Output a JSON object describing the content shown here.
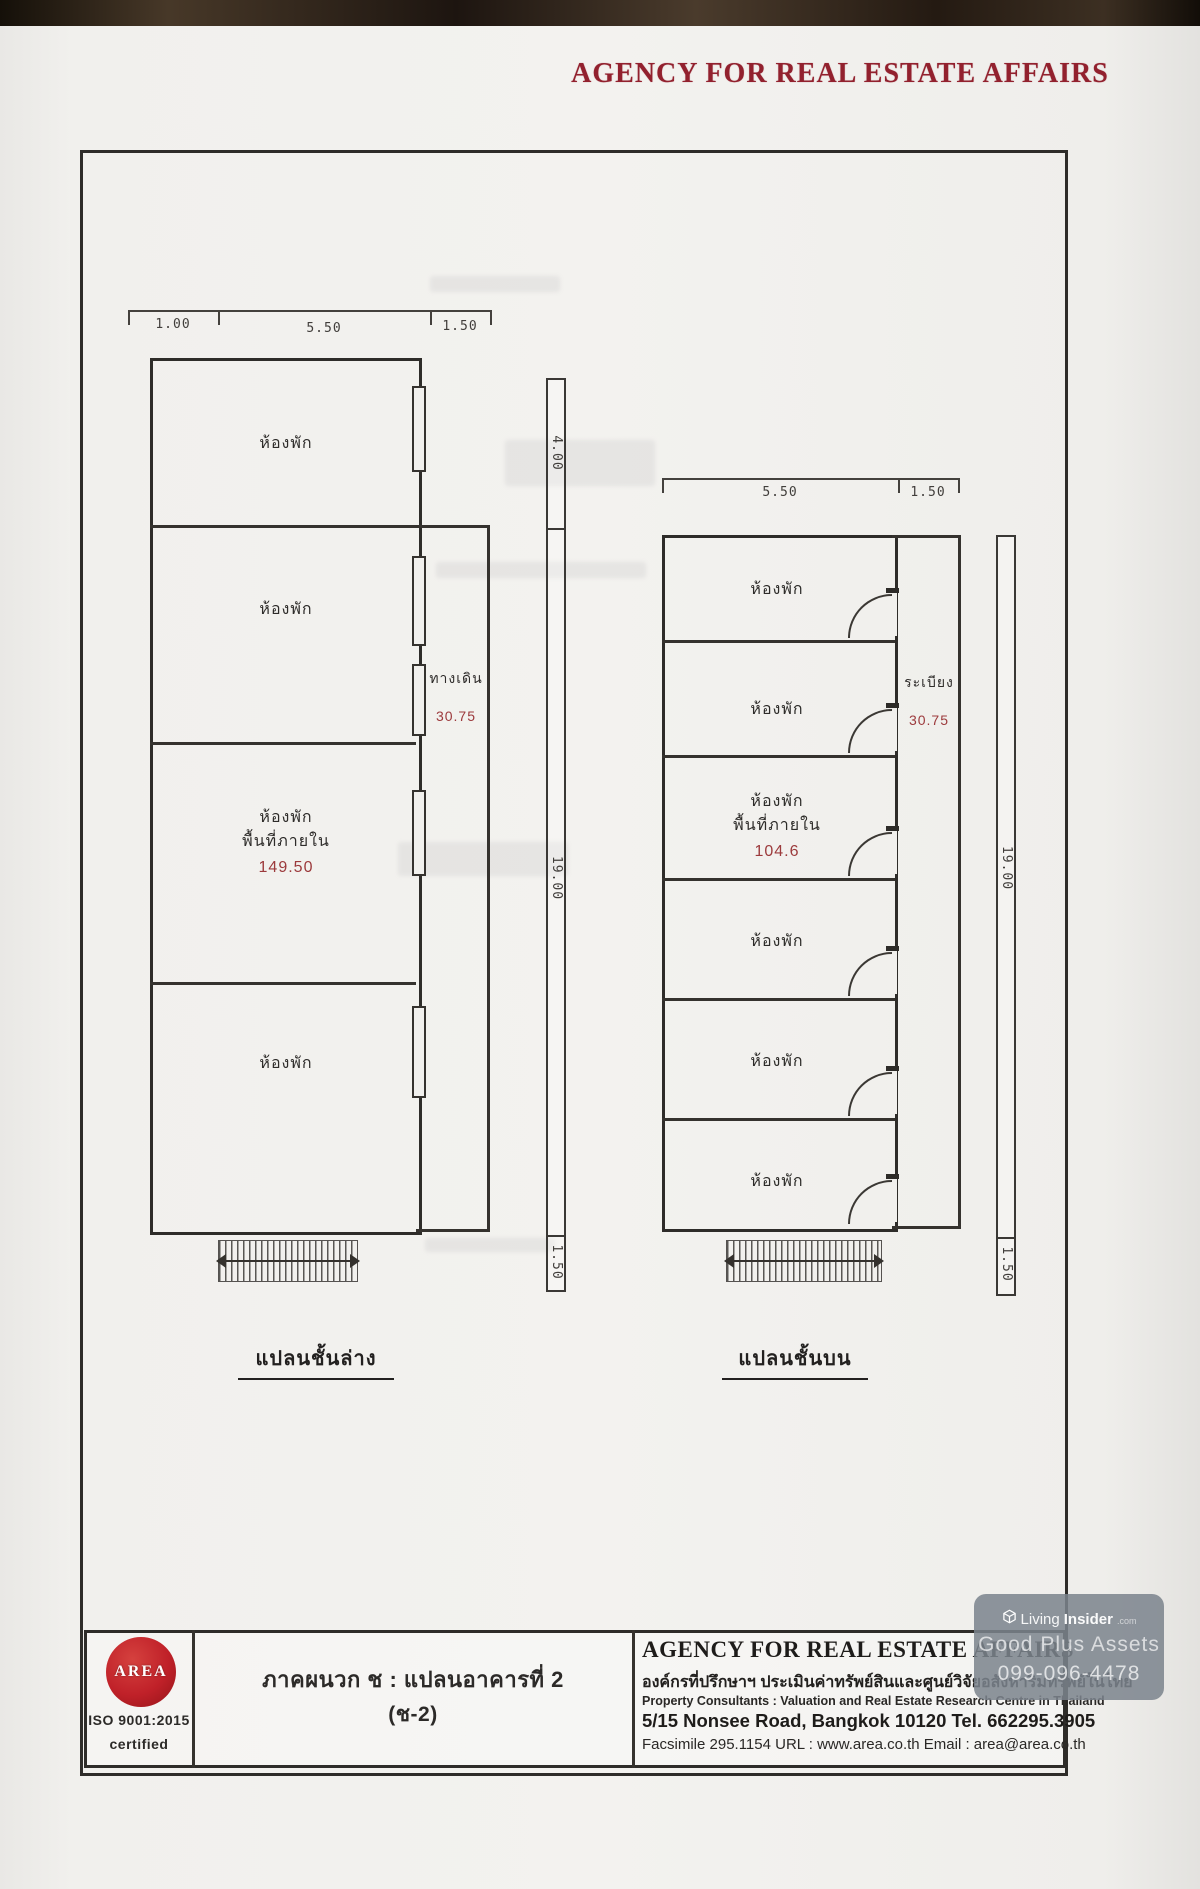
{
  "document": {
    "header_title": "AGENCY FOR REAL ESTATE AFFAIRS"
  },
  "colors": {
    "header_red": "#92212e",
    "plan_red": "#9c3a3c",
    "logo_red": "#c02129",
    "line_dark": "#35322e",
    "paper": "#f1f0ed",
    "watermark_bg": "#7c838d"
  },
  "left_plan": {
    "caption": "แปลนชั้นล่าง",
    "top_dims": [
      "1.00",
      "5.50",
      "1.50"
    ],
    "side_dims": [
      "4.00",
      "19.00",
      "1.50"
    ],
    "rooms": [
      "ห้องพัก",
      "ห้องพัก",
      "ห้องพัก",
      "ห้องพัก"
    ],
    "area_label": "พื้นที่ภายใน",
    "area_value": "149.50",
    "corridor_label": "ทางเดิน",
    "corridor_value": "30.75"
  },
  "right_plan": {
    "caption": "แปลนชั้นบน",
    "top_dims": [
      "5.50",
      "1.50"
    ],
    "side_dims": [
      "19.00",
      "1.50"
    ],
    "rooms": [
      "ห้องพัก",
      "ห้องพัก",
      "ห้องพัก",
      "ห้องพัก",
      "ห้องพัก",
      "ห้องพัก"
    ],
    "area_label": "พื้นที่ภายใน",
    "area_value": "104.6",
    "balcony_label": "ระเบียง",
    "balcony_value": "30.75"
  },
  "footer": {
    "logo_text": "AREA",
    "iso_line": "ISO 9001:2015",
    "iso_sub": "certified",
    "appendix_title": "ภาคผนวก ช : แปลนอาคารที่ 2",
    "appendix_code": "(ช-2)",
    "company_en": "AGENCY FOR REAL ESTATE AFFAIRS",
    "company_th": "องค์กรที่ปรึกษาฯ ประเมินค่าทรัพย์สินและศูนย์วิจัยอสังหาริมทรัพย์ในไทย",
    "consultants_line": "Property  Consultants :  Valuation and Real Estate Research Centre in Thailand",
    "address_line": "5/15 Nonsee  Road, Bangkok  10120   Tel. 662295.3905",
    "contact_line": "Facsimile 295.1154 URL :  www.area.co.th   Email : area@area.co.th"
  },
  "watermark": {
    "brand_prefix": "Living",
    "brand_suffix": "Insider",
    "brand_tld": ".com",
    "company": "Good Plus Assets",
    "phone": "099-096-4478"
  }
}
